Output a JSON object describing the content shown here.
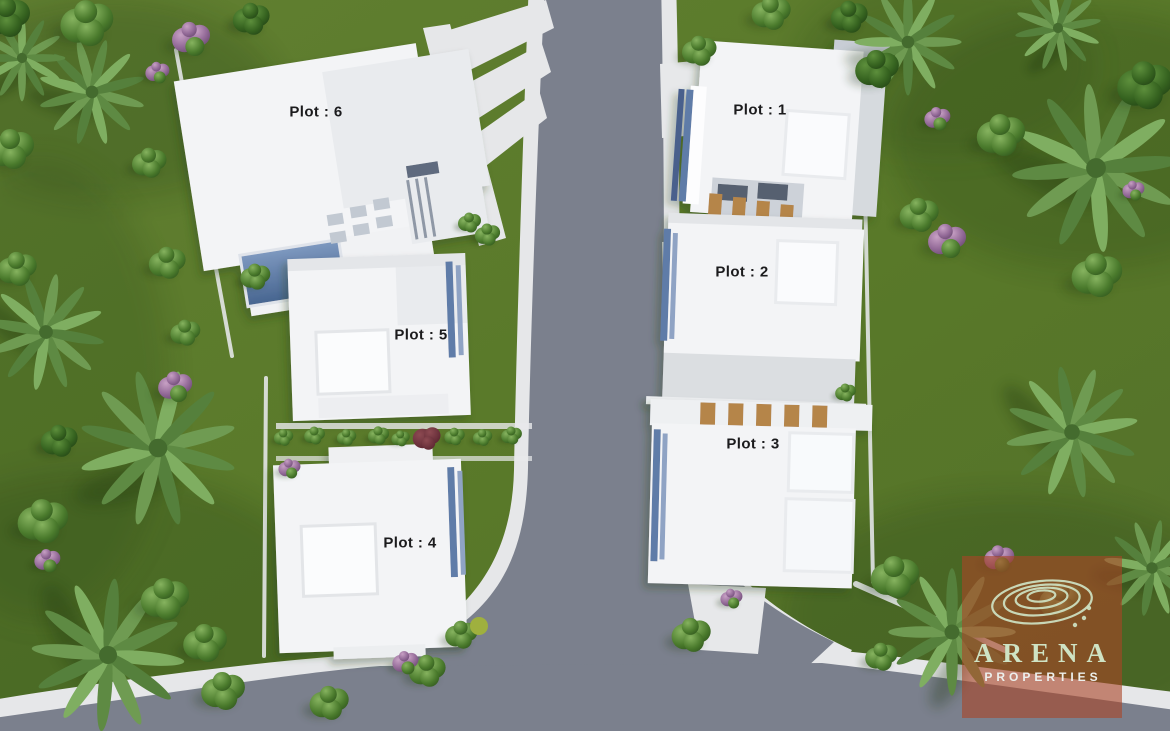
{
  "title": "Residential development site plan render",
  "plots": [
    {
      "id": 1,
      "label": "Plot :  1"
    },
    {
      "id": 2,
      "label": "Plot : 2"
    },
    {
      "id": 3,
      "label": "Plot : 3"
    },
    {
      "id": 4,
      "label": "Plot : 4"
    },
    {
      "id": 5,
      "label": "Plot : 5"
    },
    {
      "id": 6,
      "label": "Plot : 6"
    }
  ],
  "watermark": {
    "brand": "ARENA",
    "subtitle": "PROPERTIES"
  },
  "colors": {
    "grass": "#5c7b2d",
    "road": "#7b808d",
    "sidewalk": "#e6e7e9",
    "building": "#f3f4f6",
    "buildingShade": "#e9ebee",
    "patio": "#dbdee1",
    "accentBlue": "#5e7ba8",
    "accentBlueLight": "#8fa3c4",
    "pergolaWood": "#b5854a",
    "watermarkOverlay": "rgba(170,69,39,0.6)",
    "logoText": "#cfe3c4",
    "subtitleText": "#ecefec",
    "labelText": "#1b1b1d"
  }
}
